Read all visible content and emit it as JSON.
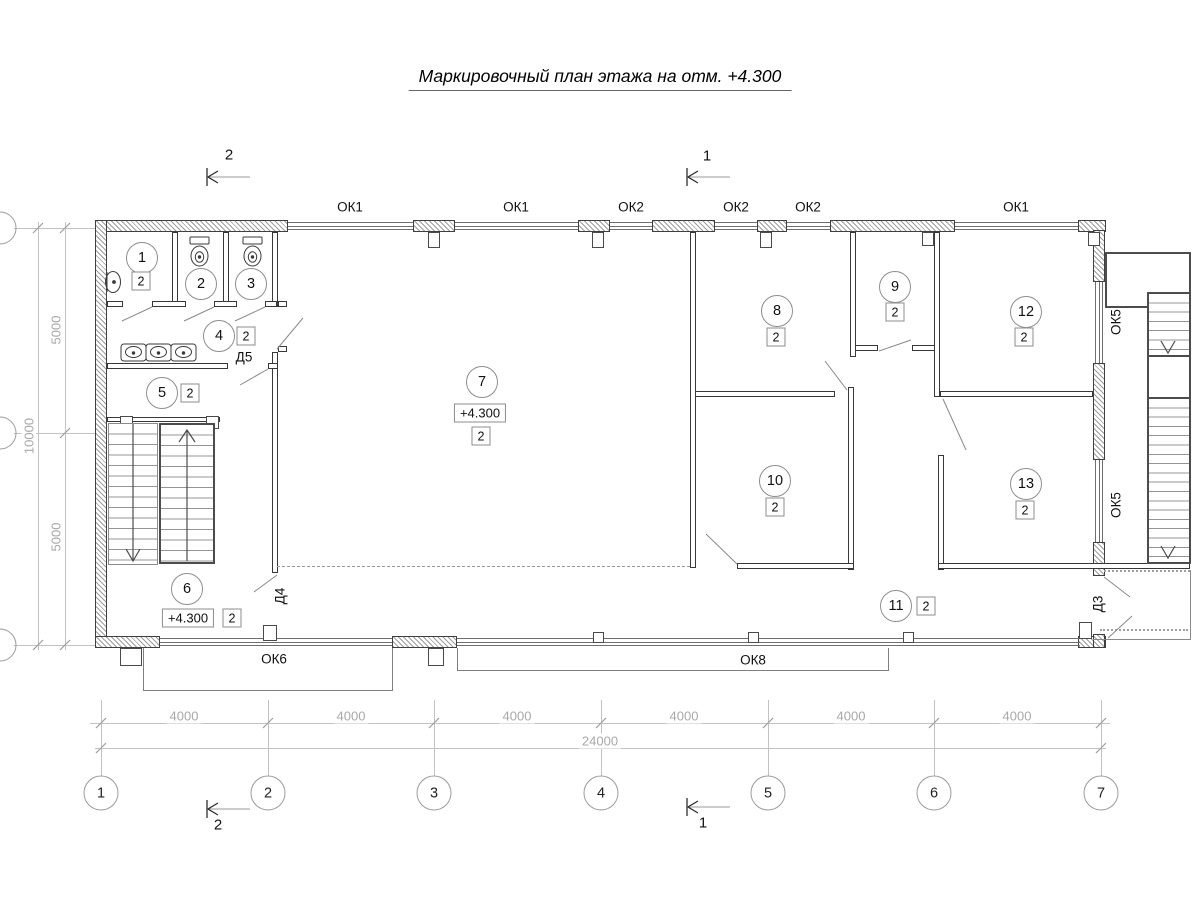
{
  "title": "Маркировочный план этажа на отм. +4.300",
  "sections": {
    "mark1": "1",
    "mark2": "2"
  },
  "windows": {
    "top": [
      "ОК1",
      "ОК1",
      "ОК2",
      "ОК2",
      "ОК2",
      "ОК1"
    ],
    "right": [
      "ОК5",
      "ОК5"
    ],
    "bottom": [
      "ОК6",
      "ОК8"
    ]
  },
  "doors": {
    "d3": "Д3",
    "d4": "Д4",
    "d5": "Д5"
  },
  "rooms": [
    {
      "number": "1",
      "type": "2"
    },
    {
      "number": "2"
    },
    {
      "number": "3"
    },
    {
      "number": "4",
      "type": "2"
    },
    {
      "number": "5",
      "type": "2"
    },
    {
      "number": "6",
      "type": "2",
      "elevation": "+4.300"
    },
    {
      "number": "7",
      "type": "2",
      "elevation": "+4.300"
    },
    {
      "number": "8",
      "type": "2"
    },
    {
      "number": "9",
      "type": "2"
    },
    {
      "number": "10",
      "type": "2"
    },
    {
      "number": "11",
      "type": "2"
    },
    {
      "number": "12",
      "type": "2"
    },
    {
      "number": "13",
      "type": "2"
    }
  ],
  "axes": {
    "horizontal": [
      "1",
      "2",
      "3",
      "4",
      "5",
      "6",
      "7"
    ]
  },
  "dimensions": {
    "spans": [
      "4000",
      "4000",
      "4000",
      "4000",
      "4000",
      "4000"
    ],
    "total": "24000",
    "left_segments": [
      "5000",
      "5000"
    ],
    "left_total": "10000"
  },
  "colors": {
    "wall_line": "#3f3f3f",
    "dim_line": "#c2c2c2",
    "dim_text": "#a8a8a8",
    "label_text": "#111111"
  }
}
